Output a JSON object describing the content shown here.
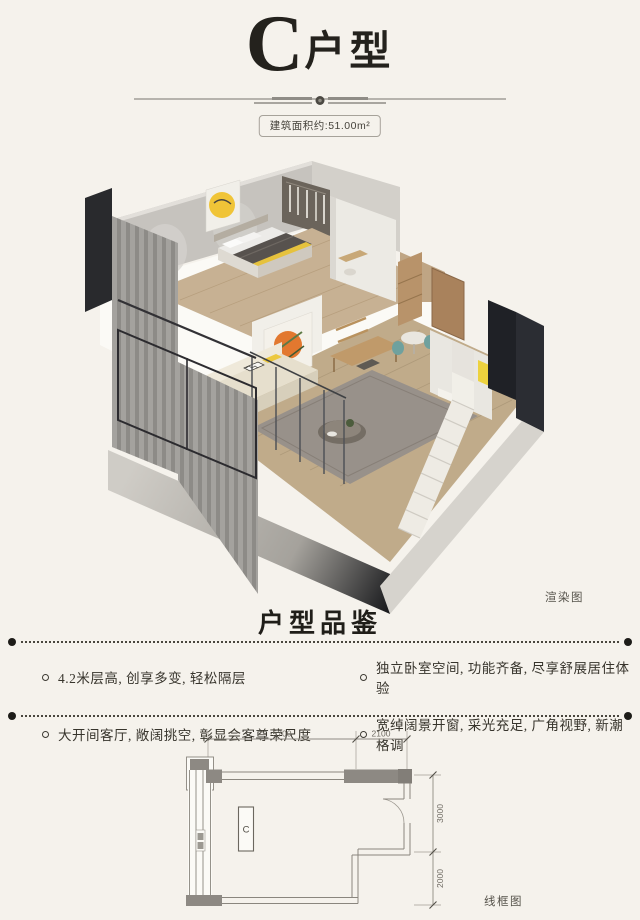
{
  "header": {
    "title_initial": "C",
    "title_suffix": "户型",
    "area_badge": "建筑面积约:51.00m²"
  },
  "render_figure": {
    "caption": "渲染图"
  },
  "features_section": {
    "heading": "户型品鉴",
    "features": [
      {
        "text": "4.2米层高, 创享多变, 轻松隔层"
      },
      {
        "text": "独立卧室空间, 功能齐备, 尽享舒展居住体验"
      },
      {
        "text": "大开间客厅, 敞阔挑空, 彰显会客尊荣尺度"
      },
      {
        "text": "宽绰阔景开窗, 采光充足, 广角视野, 新潮格调"
      }
    ]
  },
  "plan_figure": {
    "caption": "线框图",
    "unit_label": "C",
    "dimensions": {
      "top_left": "5700",
      "top_right": "2100",
      "right_upper": "3000",
      "right_lower": "2000"
    }
  },
  "colors": {
    "page_background": "#f5f2ec",
    "accent_yellow": "#f0c437",
    "accent_orange": "#e2782f",
    "wall_grey": "#c6c3be",
    "text_dark": "#2e2b25"
  }
}
